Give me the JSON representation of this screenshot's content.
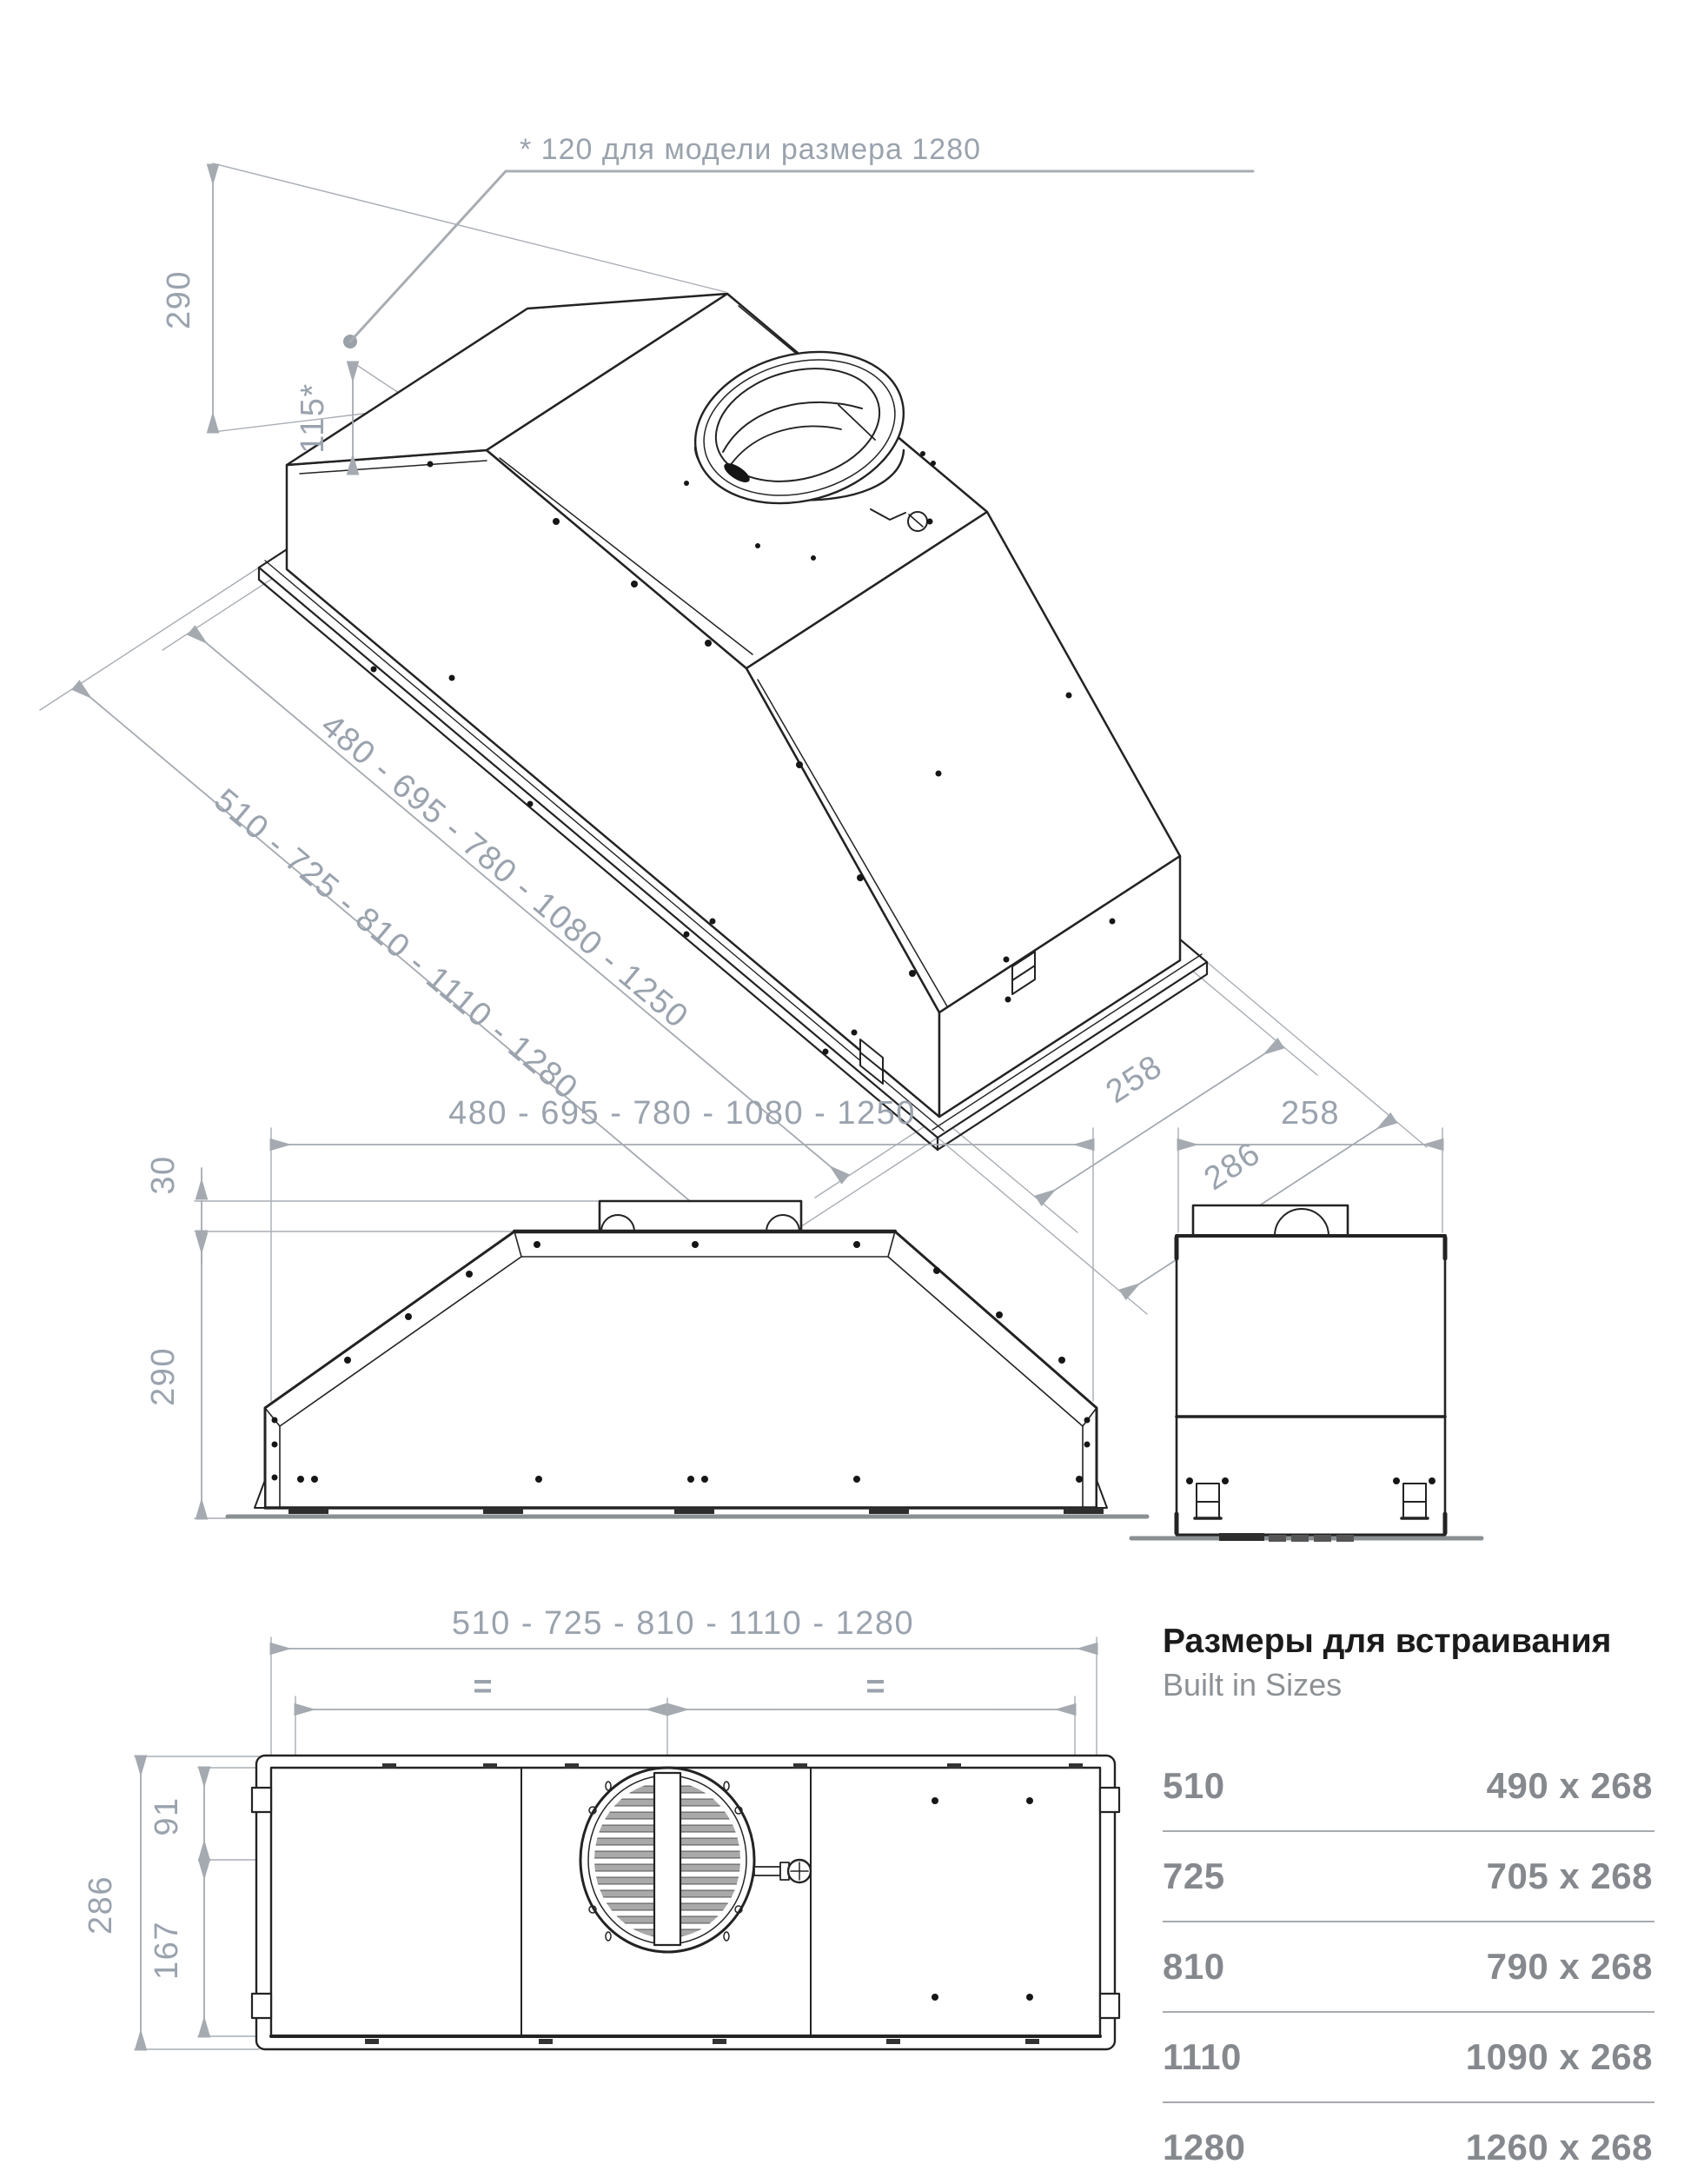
{
  "annotation": {
    "note": "* 120 для модели размера 1280"
  },
  "iso": {
    "dim_height": "290",
    "dim_height2": "115*",
    "dim_len_outer": "480 - 695 - 780 - 1080 - 1250",
    "dim_len_inner": "510 - 725 - 810 - 1110 - 1280",
    "dim_depth": "258",
    "dim_depth_flange": "286"
  },
  "front": {
    "dim_width": "480 - 695 - 780 - 1080 - 1250",
    "dim_collar": "30",
    "dim_height": "290"
  },
  "side": {
    "dim_depth": "258"
  },
  "plan": {
    "dim_width": "510 - 725 - 810 - 1110 - 1280",
    "eq_left": "=",
    "eq_right": "=",
    "dim_front": "91",
    "dim_back": "167",
    "dim_depth": "286"
  },
  "table": {
    "title_ru": "Размеры для встраивания",
    "title_en": "Built in Sizes",
    "rows": [
      {
        "model": "510",
        "size": "490 x 268"
      },
      {
        "model": "725",
        "size": "705 x 268"
      },
      {
        "model": "810",
        "size": "790 x 268"
      },
      {
        "model": "1110",
        "size": "1090 x 268"
      },
      {
        "model": "1280",
        "size": "1260 x 268"
      }
    ]
  },
  "colors": {
    "line": "#232323",
    "dim": "#a4aab0",
    "dim_text": "#9aa3ad",
    "title": "#1b1b1b",
    "muted": "#85898d"
  }
}
